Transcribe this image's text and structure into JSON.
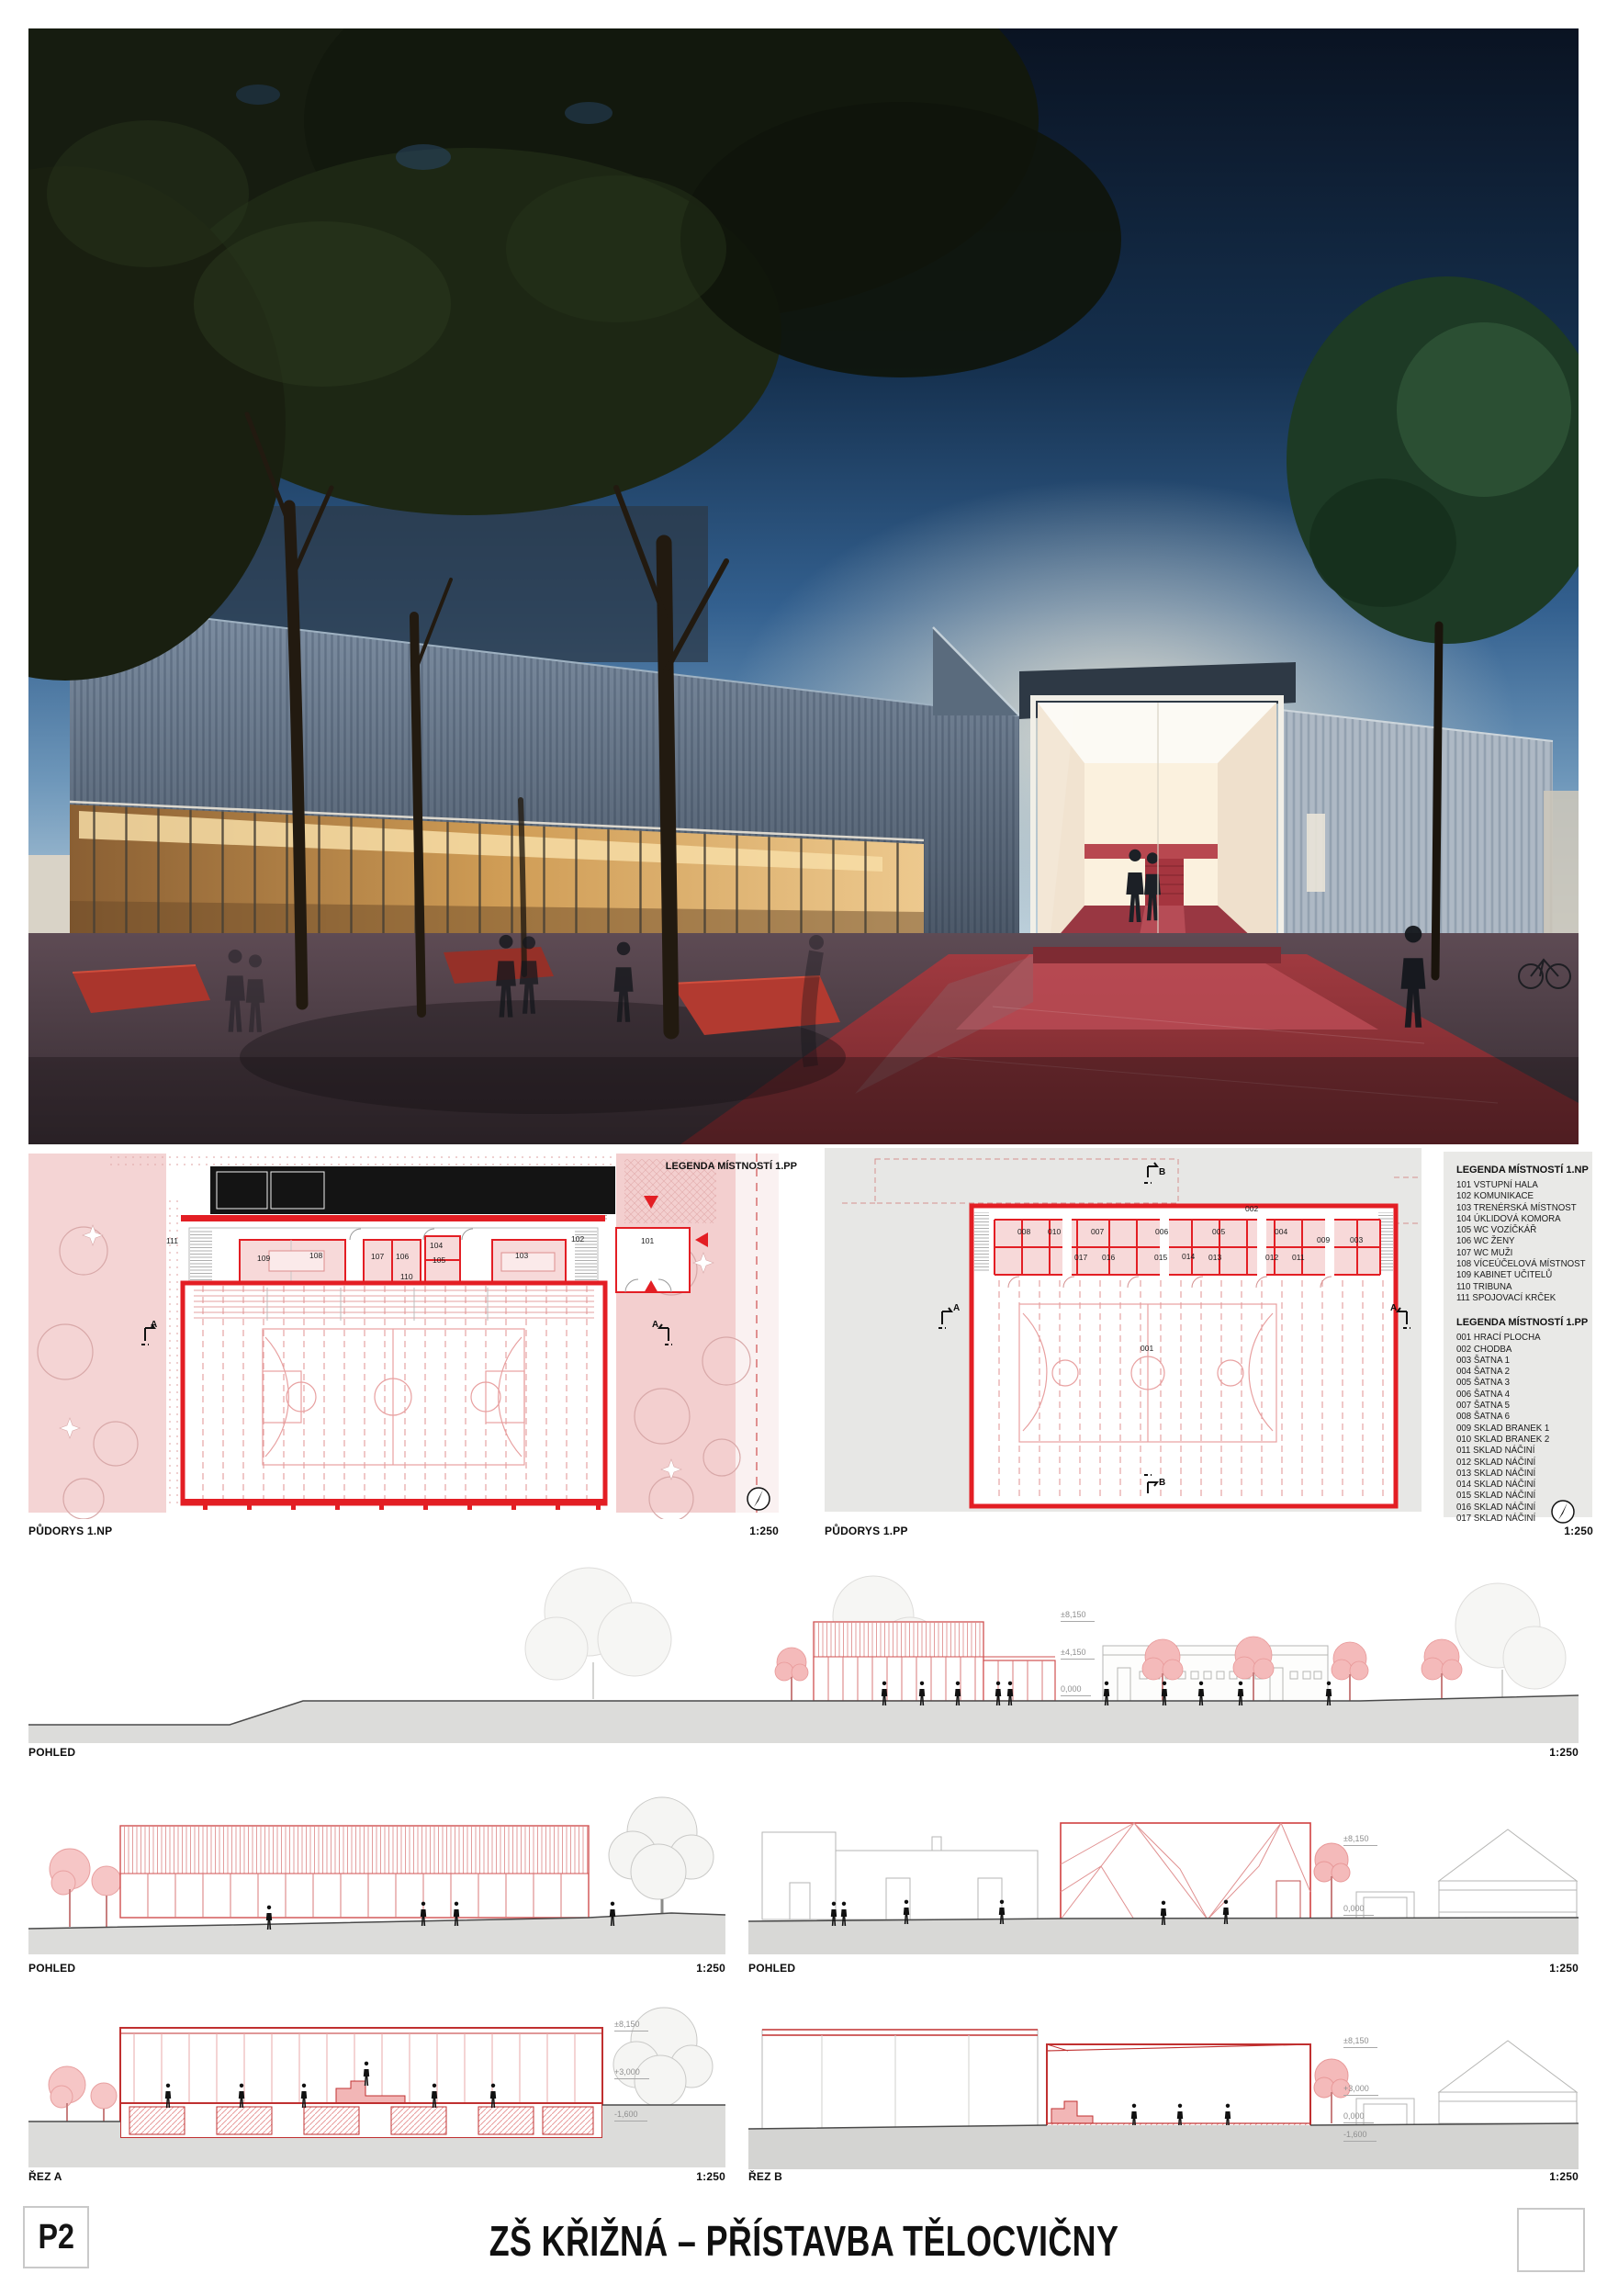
{
  "board": {
    "sheet_code": "P2",
    "title": "ZŠ KŘIŽNÁ – PŘÍSTAVBA TĚLOCVIČNY"
  },
  "colors": {
    "accent_red": "#e31e24",
    "plan_pink": "#f7d9d9",
    "drawing_gray": "#e7e7e5",
    "render_sky": "#15304e"
  },
  "plans": {
    "np": {
      "caption": "PŮDORYS 1.NP",
      "scale": "1:250",
      "legend_title": "LEGENDA MÍSTNOSTÍ 1.PP",
      "section_marker": "A",
      "rooms": [
        "111",
        "109",
        "108",
        "107",
        "106",
        "104",
        "105",
        "103",
        "102",
        "101",
        "110"
      ]
    },
    "pp": {
      "caption": "PŮDORYS 1.PP",
      "scale": "1:250",
      "section_marker_a": "A",
      "section_marker_b": "B",
      "corridor": "002",
      "court": "001",
      "rooms_top": [
        "008",
        "010",
        "007",
        "006",
        "005",
        "004",
        "009",
        "003"
      ],
      "rooms_bottom": [
        "017",
        "016",
        "015",
        "014",
        "013",
        "012",
        "011"
      ]
    },
    "legend_np": {
      "title": "LEGENDA MÍSTNOSTÍ 1.NP",
      "items": [
        "101  VSTUPNÍ HALA",
        "102  KOMUNIKACE",
        "103  TRENÉRSKÁ MÍSTNOST",
        "104  ÚKLIDOVÁ KOMORA",
        "105  WC VOZÍČKÁŘ",
        "106  WC ŽENY",
        "107  WC MUŽI",
        "108  VÍCEÚČELOVÁ MÍSTNOST",
        "109  KABINET UČITELŮ",
        "110  TRIBUNA",
        "111  SPOJOVACÍ KRČEK"
      ]
    },
    "legend_pp": {
      "title": "LEGENDA MÍSTNOSTÍ 1.PP",
      "items": [
        "001  HRACÍ PLOCHA",
        "002 CHODBA",
        "003  ŠATNA 1",
        "004  ŠATNA 2",
        "005  ŠATNA 3",
        "006  ŠATNA 4",
        "007  ŠATNA 5",
        "008  ŠATNA 6",
        "009  SKLAD BRANEK 1",
        "010  SKLAD BRANEK 2",
        "011  SKLAD NÁČINÍ",
        "012  SKLAD NÁČINÍ",
        "013  SKLAD NÁČINÍ",
        "014  SKLAD NÁČINÍ",
        "015  SKLAD NÁČINÍ",
        "016  SKLAD NÁČINÍ",
        "017  SKLAD NÁČINÍ"
      ]
    }
  },
  "elevations": {
    "pohled_main": {
      "caption": "POHLED",
      "scale": "1:250",
      "levels": {
        "top": "±8,150",
        "mid": "±4,150",
        "zero": "0,000"
      }
    },
    "pohled_west": {
      "caption": "POHLED",
      "scale": "1:250"
    },
    "pohled_east": {
      "caption": "POHLED",
      "scale": "1:250",
      "levels": {
        "top": "±8,150",
        "zero": "0,000"
      }
    },
    "rez_a": {
      "caption": "ŘEZ A",
      "scale": "1:250",
      "levels": {
        "top": "±8,150",
        "mid": "+3,000",
        "bottom": "-1,600"
      }
    },
    "rez_b": {
      "caption": "ŘEZ B",
      "scale": "1:250",
      "levels": {
        "top": "±8,150",
        "mid": "+3,000",
        "zero": "0,000",
        "bottom": "-1,600"
      }
    }
  }
}
